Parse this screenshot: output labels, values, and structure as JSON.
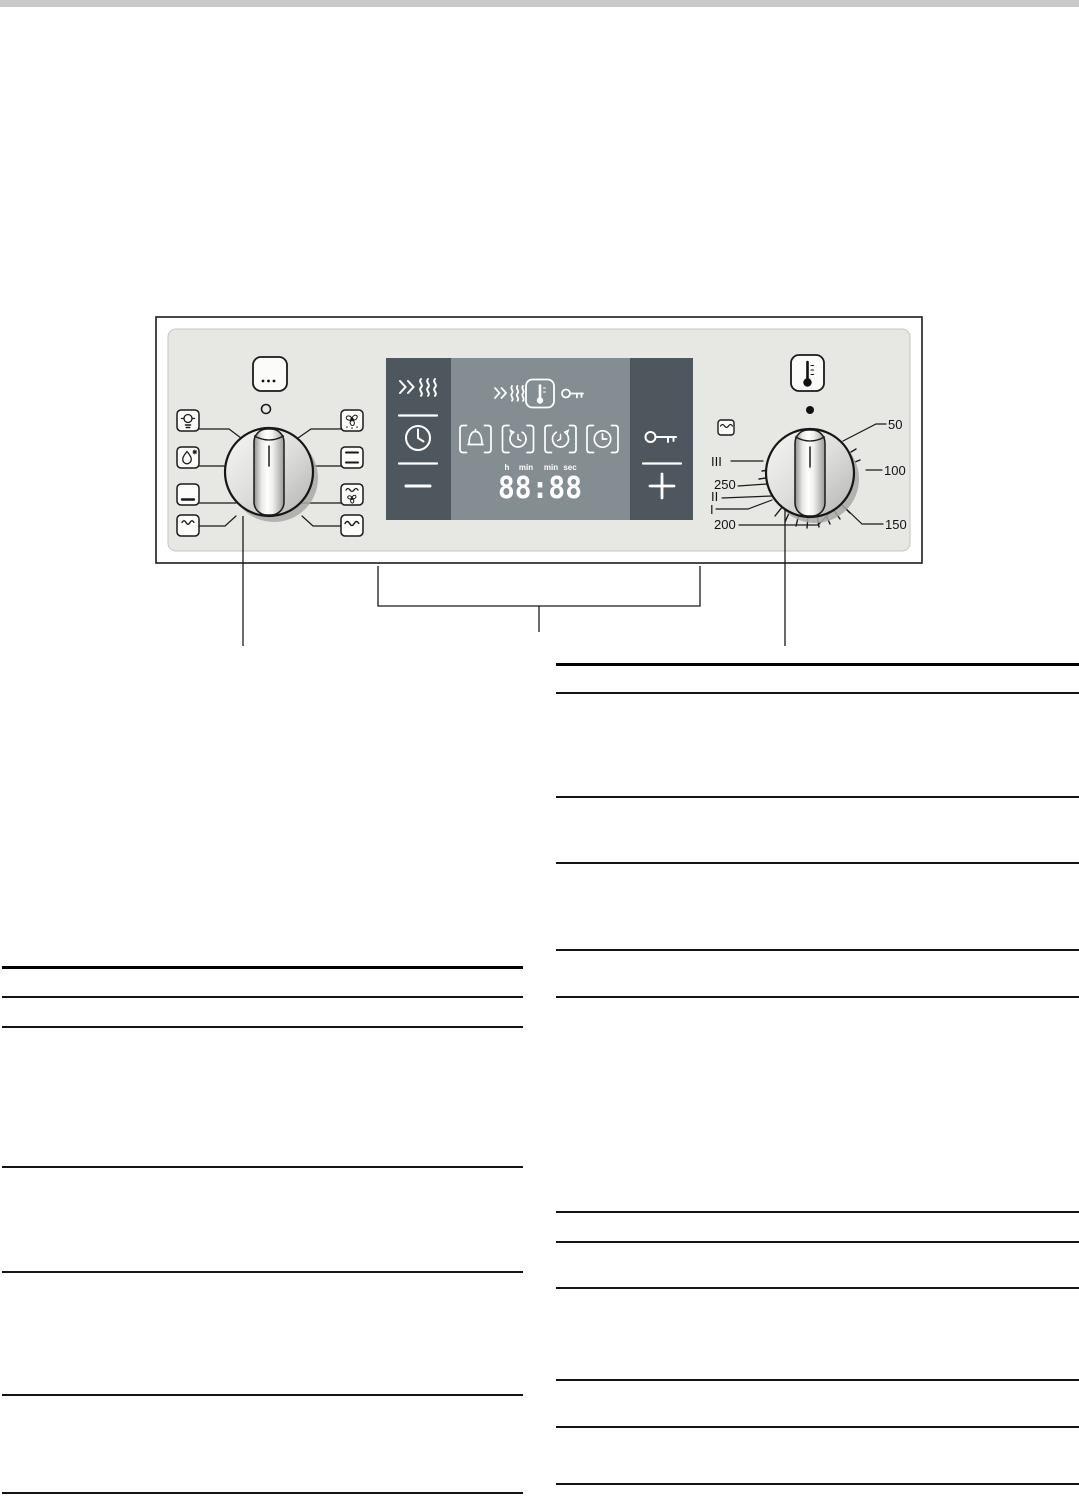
{
  "page": {
    "bg": "#ffffff",
    "header_bar_color": "#c9c9c9"
  },
  "panel": {
    "bg": "#e7e7e4",
    "display": {
      "dark_color": "#4d575d",
      "light_color": "#848d91",
      "time": "88:88",
      "units": [
        "h",
        "min",
        "min",
        "sec"
      ],
      "left_buttons": [
        "rapid-heat",
        "clock",
        "minus"
      ],
      "status_icons": [
        "rapid-heat",
        "temperature",
        "child-lock-key"
      ],
      "program_icons": [
        "alarm-bell",
        "cooking-time",
        "end-time",
        "clock"
      ],
      "right_buttons": [
        "child-lock-key",
        "plus"
      ]
    },
    "function_knob": {
      "top_button": "more-functions",
      "left_symbols": [
        "oven-light",
        "defrost",
        "bottom-heat",
        "grill-small"
      ],
      "right_symbols": [
        "hot-air",
        "top-bottom-heat",
        "hot-air-grill",
        "grill-large"
      ]
    },
    "temperature_knob": {
      "top_symbol": "thermometer",
      "side_symbol": "grill",
      "temp_labels": [
        "50",
        "100",
        "150",
        "200",
        "250"
      ],
      "grill_levels": [
        "I",
        "II",
        "III"
      ]
    }
  }
}
